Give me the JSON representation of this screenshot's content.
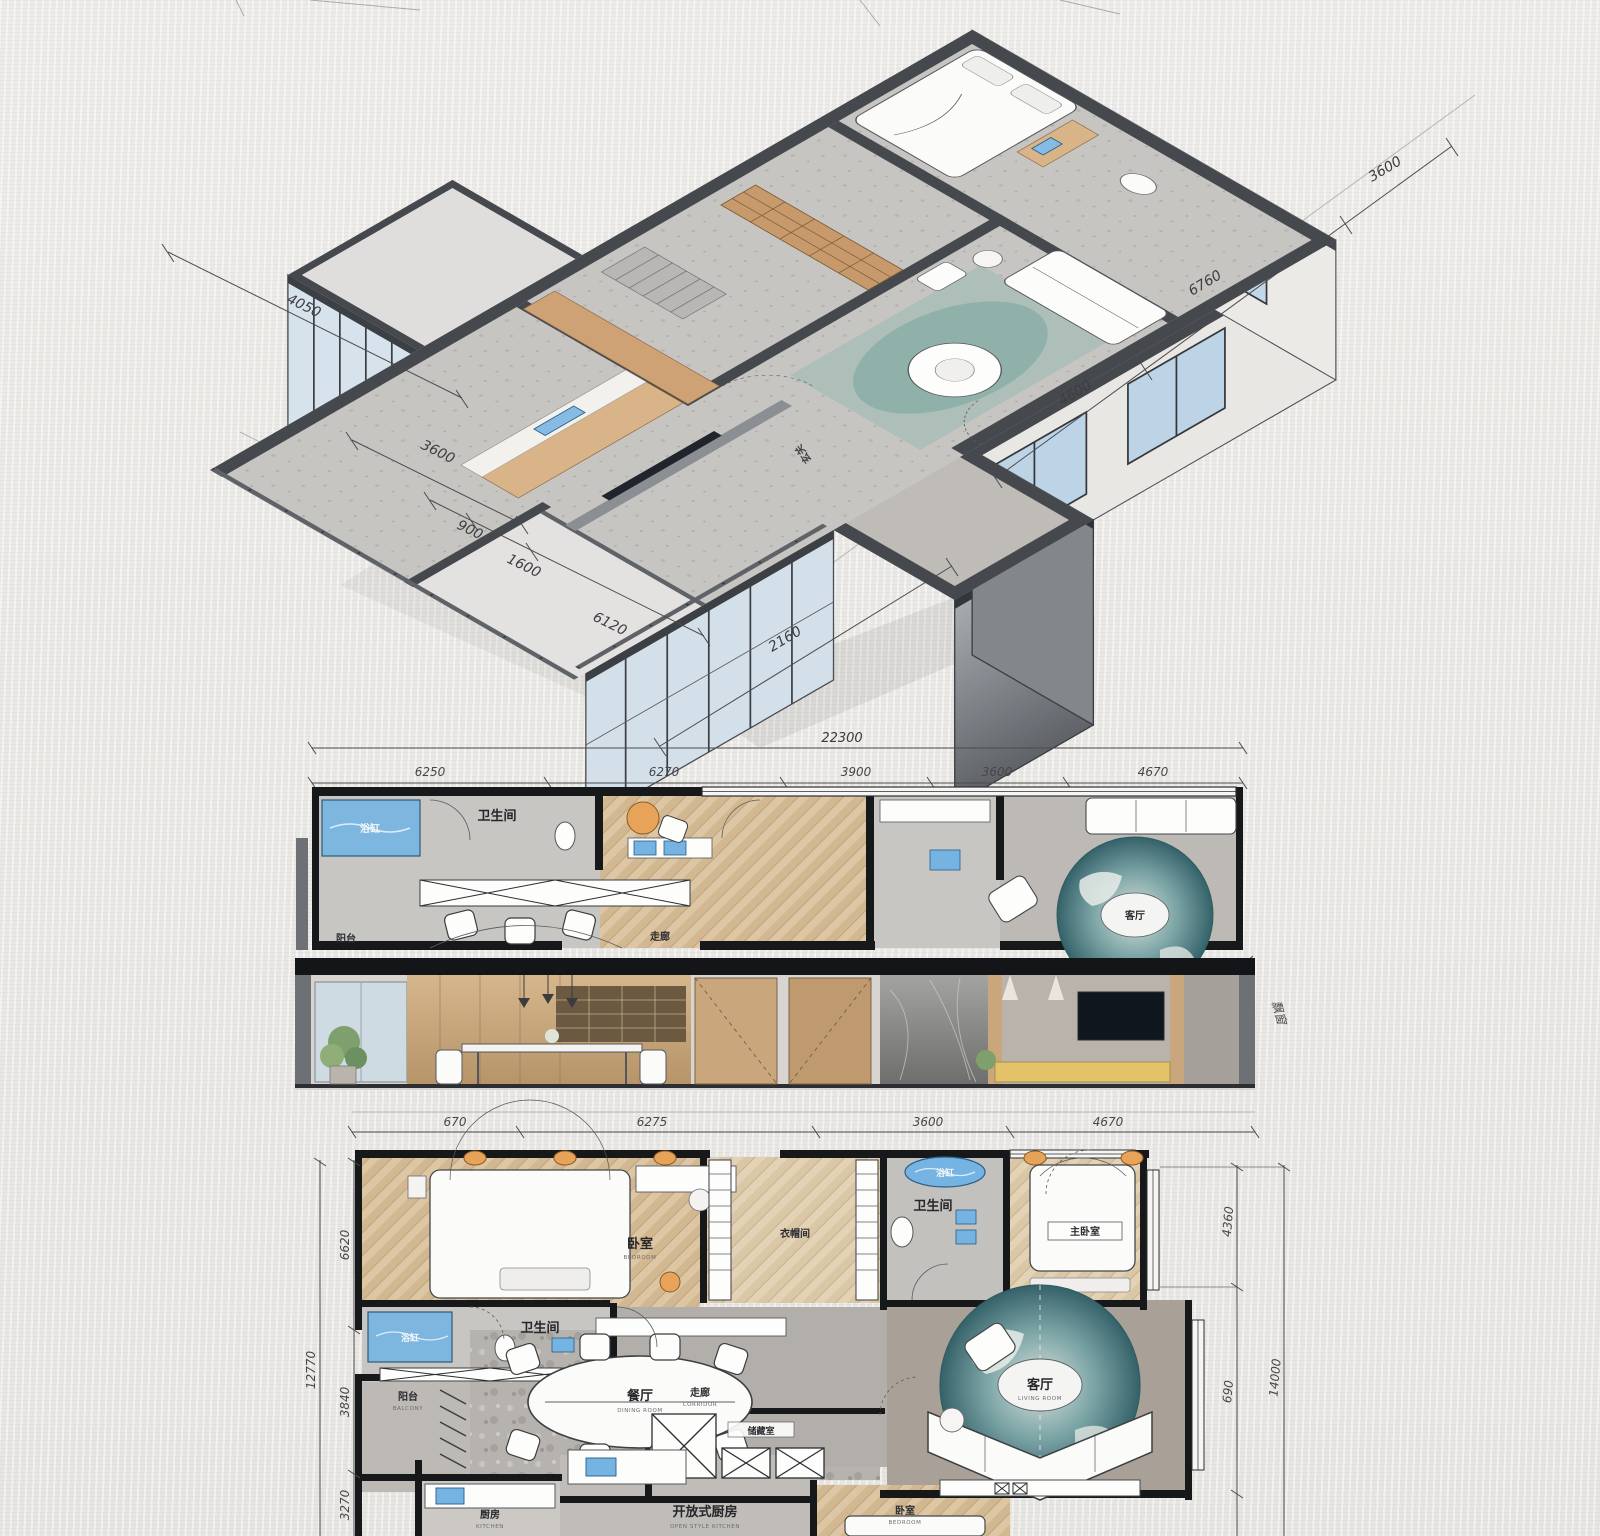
{
  "artwork": {
    "kind": "hand-drawn interior architectural rendering",
    "views": [
      "axonometric cutaway sketch",
      "partial floor plan strip",
      "interior section elevation",
      "full floor plan"
    ],
    "language": "zh-CN"
  },
  "colors": {
    "paper": "#eae8e5",
    "wall_dark": "#2c2e31",
    "wall_gray": "#45484d",
    "wood_panel": "#cfa276",
    "wood_floor": "#dcc5a3",
    "glass_blue": "#c2d8e8",
    "fixture_blue": "#74b3e2",
    "rug_teal": "#41737b",
    "lamp_orange": "#e8a35b",
    "sofa_yellow": "#e3c26a"
  },
  "iso": {
    "entry_label": "玄关",
    "dim_left": "4050",
    "dims_lower_left": [
      "3600",
      "900",
      "1600",
      "6120"
    ],
    "dim_bottom": "2160",
    "dims_right": [
      "4600",
      "6760",
      "3600"
    ]
  },
  "strip": {
    "dim_total": "22300",
    "dims_top": [
      "6250",
      "6270",
      "3900",
      "3600",
      "4670"
    ],
    "bathtub": "浴缸",
    "bathroom": "卫生间",
    "balcony": "阳台",
    "corridor": "走廊",
    "living": "客厅",
    "living_en": "LIVING ROOM",
    "bay_note": "飘窗"
  },
  "plan": {
    "dims_top": [
      "670",
      "6275",
      "3600",
      "4670"
    ],
    "dims_left": [
      "6620",
      "3840",
      "3270"
    ],
    "dim_left_total": "12770",
    "dims_right": [
      "4360",
      "690"
    ],
    "dim_right_total": "14000",
    "bedroom": "卧室",
    "bedroom_en": "BEDROOM",
    "cloak": "衣帽间",
    "cloak_en": "CLOAK ROOM",
    "bathroom": "卫生间",
    "bathroom_en": "BATHROOM",
    "bathtub": "浴缸",
    "bathtub2": "浴缸",
    "bath2": "卫生间",
    "master": "主卧室",
    "master_en": "MASTER BEDROOM",
    "living": "客厅",
    "living_en": "LIVING ROOM",
    "balcony": "阳台",
    "balcony_en": "BALCONY",
    "dining": "餐厅",
    "dining_en": "DINING ROOM",
    "corridor": "走廊",
    "corridor_en": "CORRIDOR",
    "storage": "储藏室",
    "kitchen": "厨房",
    "kitchen_en": "KITCHEN",
    "open_kitchen": "开放式厨房",
    "open_kitchen_en": "OPEN STYLE KITCHEN",
    "bedroom2": "卧室",
    "bedroom2_en": "BEDROOM"
  }
}
